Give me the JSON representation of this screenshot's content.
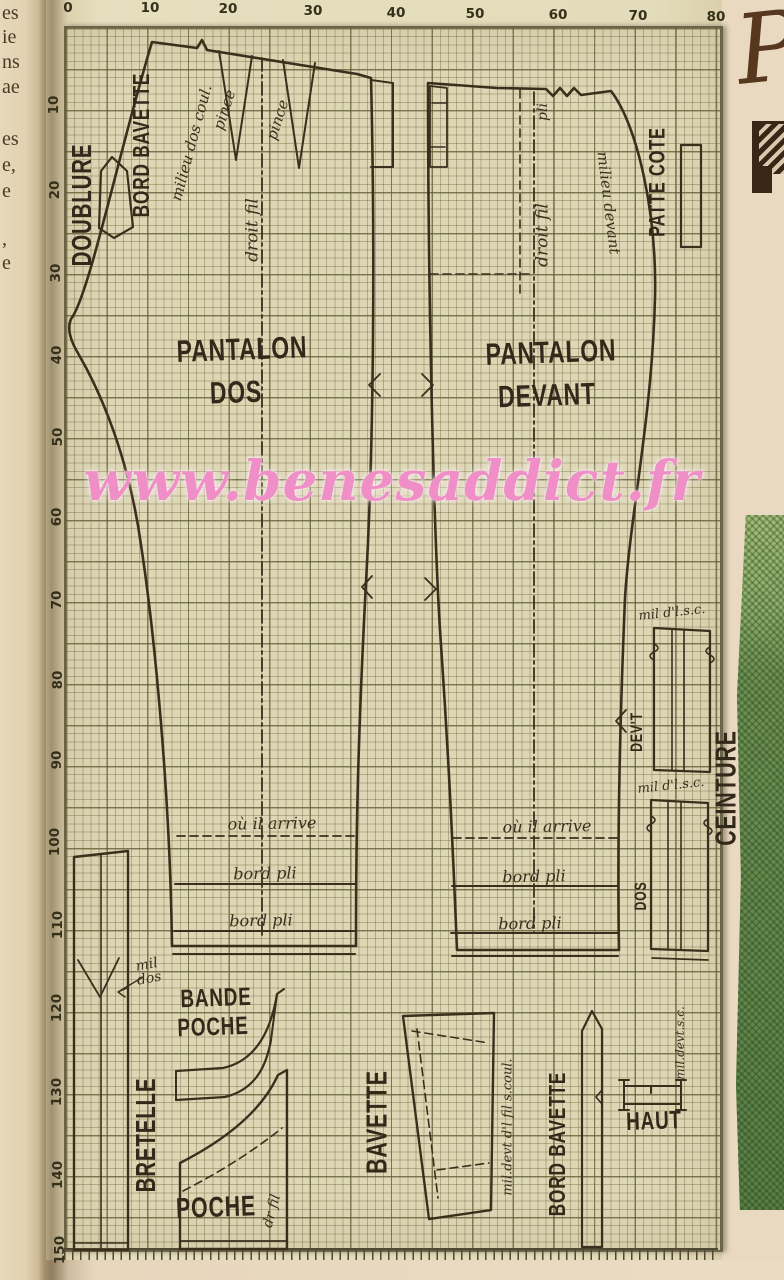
{
  "page": {
    "width": 784,
    "height": 1280
  },
  "watermark": {
    "text": "www.benesaddict.fr",
    "color": "#f08fc7"
  },
  "handwriting": {
    "text": "Pr"
  },
  "left_page_fragments": [
    {
      "t": "es",
      "y": 2
    },
    {
      "t": "ie",
      "y": 26
    },
    {
      "t": "ns",
      "y": 51
    },
    {
      "t": "ae",
      "y": 76
    },
    {
      "t": "es",
      "y": 128
    },
    {
      "t": "e,",
      "y": 154
    },
    {
      "t": "e",
      "y": 180
    },
    {
      "t": ",",
      "y": 228
    },
    {
      "t": "e",
      "y": 252
    }
  ],
  "ruler": {
    "top": [
      {
        "t": "0",
        "x": 68,
        "y": 8
      },
      {
        "t": "10",
        "x": 150,
        "y": 8
      },
      {
        "t": "20",
        "x": 228,
        "y": 9
      },
      {
        "t": "30",
        "x": 313,
        "y": 11
      },
      {
        "t": "40",
        "x": 396,
        "y": 13
      },
      {
        "t": "50",
        "x": 475,
        "y": 14
      },
      {
        "t": "60",
        "x": 558,
        "y": 15
      },
      {
        "t": "70",
        "x": 638,
        "y": 16
      },
      {
        "t": "80",
        "x": 716,
        "y": 17
      }
    ],
    "left": [
      {
        "t": "10",
        "x": 54,
        "y": 105
      },
      {
        "t": "20",
        "x": 55,
        "y": 190
      },
      {
        "t": "30",
        "x": 56,
        "y": 273
      },
      {
        "t": "40",
        "x": 57,
        "y": 355
      },
      {
        "t": "50",
        "x": 58,
        "y": 437
      },
      {
        "t": "60",
        "x": 57,
        "y": 517
      },
      {
        "t": "70",
        "x": 57,
        "y": 600
      },
      {
        "t": "80",
        "x": 58,
        "y": 680
      },
      {
        "t": "90",
        "x": 57,
        "y": 760
      },
      {
        "t": "100",
        "x": 55,
        "y": 842
      },
      {
        "t": "110",
        "x": 58,
        "y": 925
      },
      {
        "t": "120",
        "x": 57,
        "y": 1008
      },
      {
        "t": "130",
        "x": 57,
        "y": 1092
      },
      {
        "t": "140",
        "x": 58,
        "y": 1175
      },
      {
        "t": "150",
        "x": 60,
        "y": 1250
      }
    ]
  },
  "labels": [
    {
      "n": "doublure",
      "t": "DOUBLURE",
      "x": 83,
      "y": 205,
      "r": -90,
      "s": 25,
      "c": "block"
    },
    {
      "n": "bord-bavette-top",
      "t": "BORD BAVETTE",
      "x": 142,
      "y": 145,
      "r": -90,
      "s": 21,
      "c": "block"
    },
    {
      "n": "milieu-dos-coul",
      "t": "milieu dos coul.",
      "x": 192,
      "y": 143,
      "r": -75,
      "s": 15,
      "c": "script"
    },
    {
      "n": "pince-1",
      "t": "pince",
      "x": 225,
      "y": 110,
      "r": -72,
      "s": 15,
      "c": "script"
    },
    {
      "n": "pince-2",
      "t": "pince",
      "x": 278,
      "y": 120,
      "r": -72,
      "s": 15,
      "c": "script"
    },
    {
      "n": "droit-fil-dos",
      "t": "droit fil",
      "x": 253,
      "y": 230,
      "r": -90,
      "s": 17,
      "c": "script"
    },
    {
      "n": "pantalon-dos-1",
      "t": "PANTALON",
      "x": 242,
      "y": 350,
      "r": -2,
      "s": 28,
      "c": "block"
    },
    {
      "n": "pantalon-dos-2",
      "t": "DOS",
      "x": 236,
      "y": 393,
      "r": -2,
      "s": 28,
      "c": "block"
    },
    {
      "n": "pli",
      "t": "pli",
      "x": 543,
      "y": 112,
      "r": -90,
      "s": 14,
      "c": "script"
    },
    {
      "n": "droit-fil-devant",
      "t": "droit fil",
      "x": 543,
      "y": 235,
      "r": -90,
      "s": 17,
      "c": "script"
    },
    {
      "n": "milieu-devant",
      "t": "milieu devant",
      "x": 608,
      "y": 203,
      "r": 83,
      "s": 15,
      "c": "script"
    },
    {
      "n": "patte-cote",
      "t": "PATTE COTE",
      "x": 658,
      "y": 182,
      "r": -90,
      "s": 20,
      "c": "block"
    },
    {
      "n": "pantalon-devant-1",
      "t": "PANTALON",
      "x": 551,
      "y": 353,
      "r": -2,
      "s": 28,
      "c": "block"
    },
    {
      "n": "pantalon-devant-2",
      "t": "DEVANT",
      "x": 547,
      "y": 396,
      "r": -2,
      "s": 28,
      "c": "block"
    },
    {
      "n": "ou-il-arrive-dos",
      "t": "où il arrive",
      "x": 272,
      "y": 824,
      "r": -1,
      "s": 16,
      "c": "script"
    },
    {
      "n": "bord-pli-dos-1",
      "t": "bord pli",
      "x": 265,
      "y": 874,
      "r": -1,
      "s": 16,
      "c": "script"
    },
    {
      "n": "bord-pli-dos-2",
      "t": "bord pli",
      "x": 261,
      "y": 921,
      "r": -1,
      "s": 16,
      "c": "script"
    },
    {
      "n": "ou-il-arrive-devant",
      "t": "où il arrive",
      "x": 547,
      "y": 827,
      "r": -1,
      "s": 16,
      "c": "script"
    },
    {
      "n": "bord-pli-devant-1",
      "t": "bord pli",
      "x": 534,
      "y": 877,
      "r": -1,
      "s": 16,
      "c": "script"
    },
    {
      "n": "bord-pli-devant-2",
      "t": "bord pli",
      "x": 530,
      "y": 924,
      "r": -1,
      "s": 16,
      "c": "script"
    },
    {
      "n": "mil-dlsc-1",
      "t": "mil d'l.s.c.",
      "x": 672,
      "y": 613,
      "r": -6,
      "s": 13,
      "c": "script"
    },
    {
      "n": "mil-dlsc-2",
      "t": "mil d'l.s.c.",
      "x": 671,
      "y": 786,
      "r": -6,
      "s": 13,
      "c": "script"
    },
    {
      "n": "devt",
      "t": "DEV'T",
      "x": 637,
      "y": 732,
      "r": -90,
      "s": 15,
      "c": "block"
    },
    {
      "n": "dos-ceinture",
      "t": "DOS",
      "x": 641,
      "y": 896,
      "r": -90,
      "s": 15,
      "c": "block"
    },
    {
      "n": "ceinture",
      "t": "CEINTURE",
      "x": 726,
      "y": 788,
      "r": -90,
      "s": 26,
      "c": "block"
    },
    {
      "n": "mil-dos",
      "t": "mil\ndos",
      "x": 148,
      "y": 972,
      "r": -10,
      "s": 14,
      "c": "script"
    },
    {
      "n": "bande",
      "t": "BANDE",
      "x": 216,
      "y": 998,
      "r": -2,
      "s": 23,
      "c": "block"
    },
    {
      "n": "poche-bande",
      "t": "POCHE",
      "x": 213,
      "y": 1027,
      "r": -2,
      "s": 23,
      "c": "block"
    },
    {
      "n": "bretelle",
      "t": "BRETELLE",
      "x": 147,
      "y": 1135,
      "r": -90,
      "s": 25,
      "c": "block"
    },
    {
      "n": "poche",
      "t": "POCHE",
      "x": 216,
      "y": 1207,
      "r": -2,
      "s": 26,
      "c": "block"
    },
    {
      "n": "dr-fil",
      "t": "dr fil",
      "x": 272,
      "y": 1211,
      "r": -75,
      "s": 14,
      "c": "script"
    },
    {
      "n": "bavette",
      "t": "BAVETTE",
      "x": 377,
      "y": 1122,
      "r": -90,
      "s": 26,
      "c": "block"
    },
    {
      "n": "mil-devt-coul",
      "t": "mil.devt d'l fil s.coul.",
      "x": 508,
      "y": 1127,
      "r": -90,
      "s": 13,
      "c": "script"
    },
    {
      "n": "bord-bavette-bottom",
      "t": "BORD BAVETTE",
      "x": 558,
      "y": 1144,
      "r": -90,
      "s": 21,
      "c": "block"
    },
    {
      "n": "haut",
      "t": "HAUT",
      "x": 654,
      "y": 1121,
      "r": -2,
      "s": 23,
      "c": "block"
    },
    {
      "n": "mil-devt-sc",
      "t": "mil.devt.s.c.",
      "x": 680,
      "y": 1043,
      "r": -90,
      "s": 12,
      "c": "script"
    }
  ],
  "paths": [
    {
      "n": "pantalon-dos-outline",
      "w": 2.6,
      "d": "M 152 42 L 197 48 L 202 40 L 207 50 L 357 74 L 371 78 C 375 240 374 440 366 582 C 357 755 356 850 356 946 L 172 946 C 170 790 154 630 141 545 C 129 458 101 393 79 355 C 70 340 67 329 71 319 C 89 296 118 155 152 42 Z"
    },
    {
      "n": "dos-dart-1",
      "w": 2,
      "d": "M 219 51 L 236 160 L 252 56"
    },
    {
      "n": "dos-dart-2",
      "w": 2,
      "d": "M 283 60 L 299 168 L 315 63"
    },
    {
      "n": "dos-grainline",
      "w": 1.8,
      "dash": "dd",
      "d": "M 262 58 L 262 935"
    },
    {
      "n": "dos-side-tab",
      "w": 2,
      "d": "M 371 80 L 393 83 L 393 167 L 371 167"
    },
    {
      "n": "dos-ou-il-arrive-line",
      "w": 1.8,
      "dash": "d1",
      "d": "M 177 836 L 355 836"
    },
    {
      "n": "dos-bord-pli-line-1",
      "w": 2,
      "d": "M 175 884 L 356 884"
    },
    {
      "n": "dos-bord-pli-line-2",
      "w": 2,
      "d": "M 174 931 L 356 931"
    },
    {
      "n": "dos-hem-line",
      "w": 2,
      "d": "M 173 954 L 355 954"
    },
    {
      "n": "pantalon-devant-outline",
      "w": 2.6,
      "d": "M 428 83 L 497 88 L 546 89 L 553 96 L 560 88 L 567 96 L 574 88 L 581 95 L 611 91 C 638 126 657 215 655 298 C 652 418 630 515 625 598 C 620 718 617 838 619 950 L 457 950 C 453 852 449 762 441 645 C 434 545 428 300 428 83 Z"
    },
    {
      "n": "devant-waist-tab",
      "w": 1.8,
      "d": "M 430 86 L 447 88 L 447 167 L 430 167 Z"
    },
    {
      "n": "devant-tab-ticks",
      "w": 1.5,
      "d": "M 432 103 L 446 103 M 431 147 L 445 147"
    },
    {
      "n": "devant-grainline",
      "w": 1.8,
      "dash": "dd",
      "d": "M 534 92 L 534 933"
    },
    {
      "n": "devant-pli-line",
      "w": 1.6,
      "dash": "d1",
      "d": "M 520 90 L 520 298"
    },
    {
      "n": "devant-hip-line",
      "w": 1.6,
      "dash": "d1",
      "d": "M 430 274 L 533 274"
    },
    {
      "n": "devant-ou-il-arrive-line",
      "w": 1.8,
      "dash": "d1",
      "d": "M 453 838 L 617 838"
    },
    {
      "n": "devant-bord-pli-line-1",
      "w": 2,
      "d": "M 452 886 L 618 886"
    },
    {
      "n": "devant-bord-pli-line-2",
      "w": 2,
      "d": "M 451 933 L 618 933"
    },
    {
      "n": "devant-hem-line",
      "w": 2,
      "d": "M 452 956 L 618 956"
    },
    {
      "n": "notch-dos-hip",
      "w": 1.8,
      "d": "M 380 374 L 369 385 L 380 396"
    },
    {
      "n": "notch-devant-hip",
      "w": 1.8,
      "d": "M 422 374 L 433 385 L 422 396"
    },
    {
      "n": "notch-dos-knee",
      "w": 1.8,
      "d": "M 372 576 L 362 587 L 372 598"
    },
    {
      "n": "notch-devant-knee",
      "w": 1.8,
      "d": "M 425 578 L 436 589 L 425 600"
    },
    {
      "n": "notch-devant-leg",
      "w": 1.8,
      "d": "M 626 710 L 616 721 L 626 732"
    },
    {
      "n": "doublure-strip",
      "w": 2.2,
      "d": "M 112 157 L 127 171 L 133 227 L 114 238 L 99 228 L 101 171 Z"
    },
    {
      "n": "patte-cote-piece",
      "w": 2.2,
      "d": "M 681 145 L 701 145 L 701 247 L 681 247 Z"
    },
    {
      "n": "ceinture-devant-piece",
      "w": 2.2,
      "d": "M 654 628 L 710 631 L 710 772 L 654 770 Z"
    },
    {
      "n": "ceinture-devant-inner",
      "w": 1.6,
      "d": "M 672 629 L 672 770 M 684 630 L 684 771"
    },
    {
      "n": "ceinture-devant-notches",
      "w": 1.6,
      "d": "M 654 644 q 8 4 0 8 q -8 4 0 8 M 710 647 q -8 4 0 8 q 8 4 0 8"
    },
    {
      "n": "ceinture-dos-piece",
      "w": 2.2,
      "d": "M 651 800 L 708 803 L 708 951 L 651 949 Z"
    },
    {
      "n": "ceinture-dos-inner",
      "w": 1.6,
      "d": "M 668 801 L 668 950 M 681 802 L 681 950"
    },
    {
      "n": "ceinture-dos-notches",
      "w": 1.6,
      "d": "M 651 816 q 8 4 0 8 q -8 4 0 8 M 708 819 q -8 4 0 8 q 8 4 0 8"
    },
    {
      "n": "ceinture-dos-hem",
      "w": 1.8,
      "d": "M 652 958 L 708 960"
    },
    {
      "n": "bretelle-piece",
      "w": 2.4,
      "d": "M 74 857 L 128 851 L 128 1250 L 74 1250 Z"
    },
    {
      "n": "bretelle-inner",
      "w": 1.6,
      "d": "M 101 854 L 101 1250"
    },
    {
      "n": "bretelle-notch",
      "w": 1.8,
      "d": "M 78 960 L 100 997 L 119 958"
    },
    {
      "n": "bretelle-hem",
      "w": 1.6,
      "d": "M 74 1243 L 128 1243"
    },
    {
      "n": "mil-dos-arrow",
      "w": 1.4,
      "d": "M 143 977 L 118 992 M 118 992 L 127 988 M 118 992 L 125 997"
    },
    {
      "n": "bande-poche-outer",
      "w": 2.2,
      "d": "M 176 1071 L 223 1068 C 256 1061 271 1030 277 994"
    },
    {
      "n": "bande-poche-inner",
      "w": 2.2,
      "d": "M 176 1100 L 225 1097 C 258 1089 267 1062 271 1040"
    },
    {
      "n": "bande-poche-caps",
      "w": 2,
      "d": "M 176 1071 L 176 1100 M 277 994 L 271 1040 M 277 994 L 284 989"
    },
    {
      "n": "poche-outline",
      "w": 2.4,
      "d": "M 287 1070 L 287 1249 L 180 1249 L 180 1163 C 231 1137 263 1108 278 1075 Z"
    },
    {
      "n": "poche-hem",
      "w": 1.8,
      "d": "M 181 1241 L 286 1241"
    },
    {
      "n": "poche-fold-dashed",
      "w": 1.6,
      "dash": "d1",
      "d": "M 183 1191 C 220 1172 252 1152 282 1128"
    },
    {
      "n": "bavette-piece",
      "w": 2.4,
      "d": "M 403 1016 L 494 1013 L 491 1210 L 429 1219 Z"
    },
    {
      "n": "bavette-dash-1",
      "w": 1.6,
      "dash": "d1",
      "d": "M 417 1029 L 438 1198"
    },
    {
      "n": "bavette-dash-2",
      "w": 1.6,
      "dash": "d1",
      "d": "M 412 1031 L 489 1043"
    },
    {
      "n": "bavette-dash-3",
      "w": 1.6,
      "dash": "d1",
      "d": "M 437 1170 L 489 1163"
    },
    {
      "n": "bord-bavette-strip",
      "w": 2.2,
      "d": "M 582 1031 L 592 1011 L 602 1029 L 602 1247 L 582 1247 Z"
    },
    {
      "n": "bord-bavette-strip-notch",
      "w": 1.6,
      "d": "M 602 1090 L 596 1097 L 602 1104"
    },
    {
      "n": "haut-piece",
      "w": 2,
      "d": "M 624 1086 L 681 1086 M 624 1104 L 681 1104 M 624 1080 L 624 1110 M 619 1080 L 629 1080 M 619 1110 L 629 1110 M 681 1080 L 681 1110 M 676 1080 L 686 1080 M 676 1110 L 686 1110 M 651 1086 L 651 1093"
    }
  ],
  "colors": {
    "paper": "#e3dcba",
    "grid_paper": "#ded7b6",
    "line": "#3a2f1d",
    "label": "#33291a",
    "watermark_pink": "#f08fc7",
    "green_fabric": "#6f9154",
    "ink": "#3b2517"
  }
}
